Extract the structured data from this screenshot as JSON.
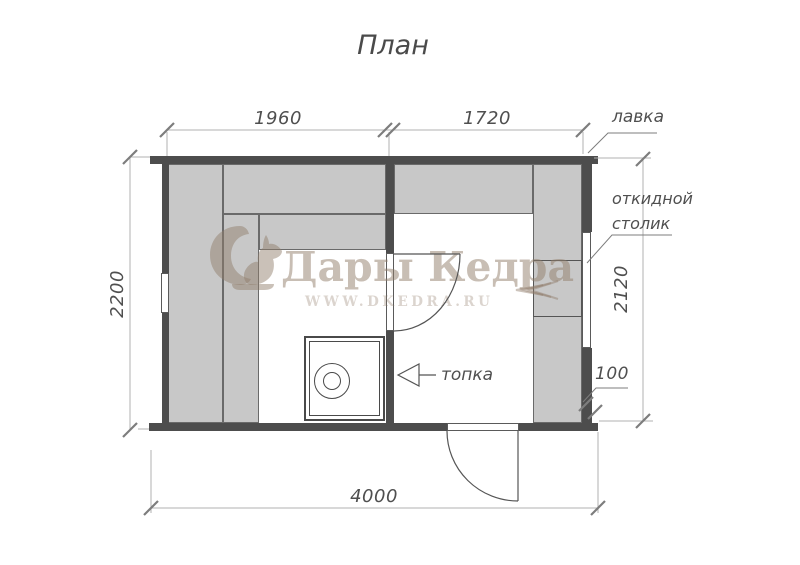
{
  "title": "План",
  "dimensions": {
    "room_left_width": "1960",
    "room_right_width": "1720",
    "height_left": "2200",
    "height_right": "2120",
    "total_width": "4000",
    "wall_thickness": "100"
  },
  "labels": {
    "bench": "лавка",
    "folding_table_line1": "откидной",
    "folding_table_line2": "столик",
    "firebox": "топка"
  },
  "watermark": {
    "brand": "Дары Кедра",
    "site": "WWW.DKEDRA.RU",
    "logo": "squirrel"
  },
  "colors": {
    "wall": "#4d4d4d",
    "bench_fill": "#c8c8c8",
    "bench_edge": "#6a6a6a",
    "dim_line": "#b0b0b0",
    "tick": "#7d7d7d",
    "text": "#4f4f4f",
    "watermark": "#917d6a",
    "background": "#ffffff"
  }
}
